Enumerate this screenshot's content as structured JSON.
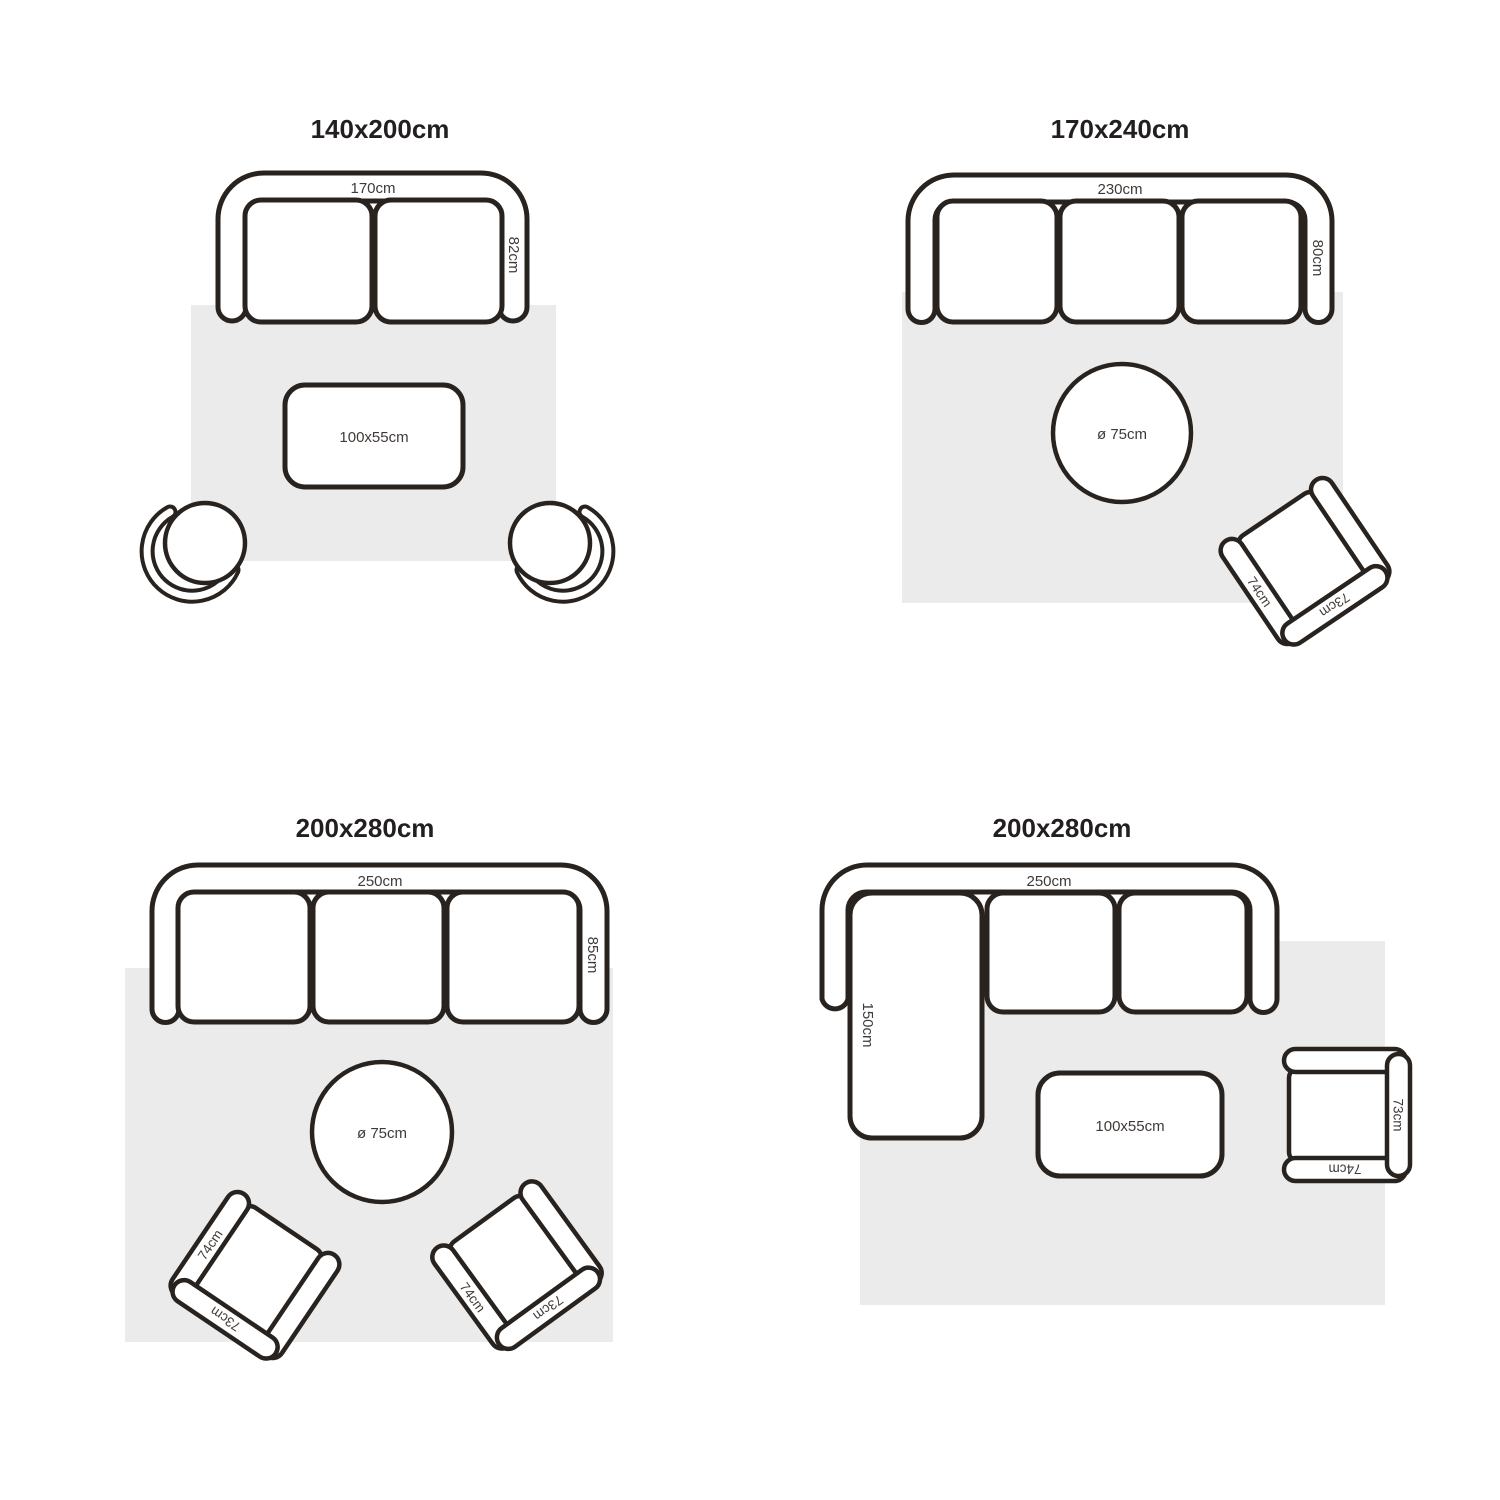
{
  "colors": {
    "outline": "#29231f",
    "rug": "#ebebeb",
    "label": "#3f3a37",
    "title": "#231f20",
    "bg": "#ffffff"
  },
  "panels": [
    {
      "title": "140x200cm",
      "sofa_width": "170cm",
      "sofa_depth": "82cm",
      "table_label": "100x55cm"
    },
    {
      "title": "170x240cm",
      "sofa_width": "230cm",
      "sofa_depth": "80cm",
      "table_label": "ø 75cm",
      "armchair": {
        "arm": "74cm",
        "back": "73cm"
      }
    },
    {
      "title": "200x280cm",
      "sofa_width": "250cm",
      "sofa_depth": "85cm",
      "table_label": "ø 75cm",
      "armchair_left": {
        "arm": "74cm",
        "back": "73cm"
      },
      "armchair_right": {
        "arm": "74cm",
        "back": "73cm"
      }
    },
    {
      "title": "200x280cm",
      "sofa_width": "250cm",
      "chaise_depth": "150cm",
      "table_label": "100x55cm",
      "armchair": {
        "arm": "74cm",
        "back": "73cm"
      }
    }
  ]
}
